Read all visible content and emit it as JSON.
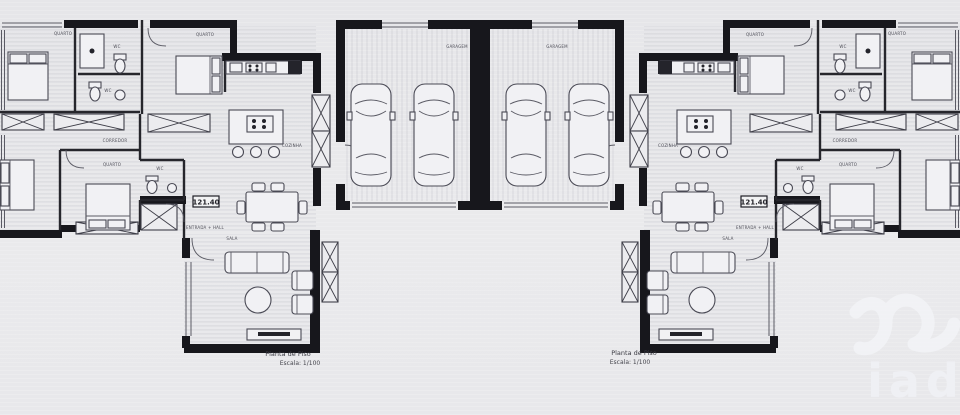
{
  "document": {
    "type": "architectural-floor-plan",
    "captions": {
      "left_title": "Planta de Piso",
      "left_scale": "Escala: 1/100",
      "right_title": "Planta de Piso",
      "right_scale": "Escala: 1/100"
    },
    "area_totals": {
      "left": "121.40",
      "right": "121.40"
    },
    "room_labels": {
      "bedroom": "QUARTO",
      "bathroom": "WC",
      "kitchen": "COZINHA",
      "living_room": "SALA",
      "corridor": "CORREDOR",
      "entrance_hall": "ENTRADA + HALL",
      "garage": "GARAGEM"
    },
    "watermark": "iad",
    "colors": {
      "paper": "#e8e8eb",
      "ink": "#17171c",
      "detail_line": "#4a4a55",
      "watermark": "#f2f3f7"
    }
  }
}
